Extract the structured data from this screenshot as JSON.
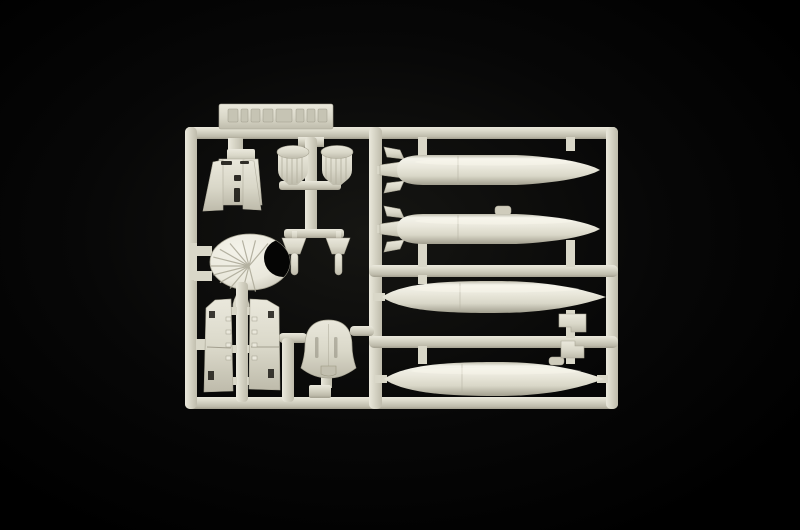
{
  "scene": {
    "description": "Photograph of a light-grey injection-moulded plastic model kit sprue (parts tree) lying on a black background",
    "sprue_contents": "embossed part-number tab with illegible raised lettering, cockpit bulkhead, two finned bombs, two small finned stores, engine fan disc, two cockpit side consoles, ejection-seat back, two small hatch plates, four external-tank / torpedo shaped stores",
    "tank_count": 4,
    "embossed_tab_text": ""
  },
  "colors": {
    "background_edge": "#000000",
    "vignette_center": "#161613",
    "vignette_mid": "#070707",
    "plastic_highlight": "#f4f3ea",
    "plastic_light": "#eae8dc",
    "plastic_base": "#d9d7c8",
    "plastic_shadow": "#bebbab",
    "plastic_deep": "#a29f8f",
    "recess_dark": "#1c1a15",
    "notch_black": "#050504"
  },
  "parts": [
    {
      "name": "part-number-tab",
      "label": "embossed part number tab (illegible)"
    },
    {
      "name": "part-cockpit-bulkhead",
      "label": "cockpit bulkhead with side frames"
    },
    {
      "name": "part-bomb-left",
      "label": "finned bomb"
    },
    {
      "name": "part-bomb-right",
      "label": "finned bomb"
    },
    {
      "name": "part-store-dart-left",
      "label": "small finned store"
    },
    {
      "name": "part-store-dart-right",
      "label": "small finned store"
    },
    {
      "name": "part-fan-disc",
      "label": "engine fan / crescent disc"
    },
    {
      "name": "part-teardrop",
      "label": "small teardrop fairing"
    },
    {
      "name": "part-console-left",
      "label": "cockpit side console"
    },
    {
      "name": "part-console-right",
      "label": "cockpit side console"
    },
    {
      "name": "part-seat-back",
      "label": "ejection seat back"
    },
    {
      "name": "part-fuel-tank-1",
      "label": "finned external tank"
    },
    {
      "name": "part-fuel-tank-2",
      "label": "finned external tank"
    },
    {
      "name": "part-fuel-tank-3",
      "label": "slipper fuel tank"
    },
    {
      "name": "part-fuel-tank-4",
      "label": "slipper fuel tank"
    },
    {
      "name": "part-hatch-plate-1",
      "label": "small hatch plate"
    },
    {
      "name": "part-hatch-plate-2",
      "label": "small hatch plate"
    }
  ]
}
